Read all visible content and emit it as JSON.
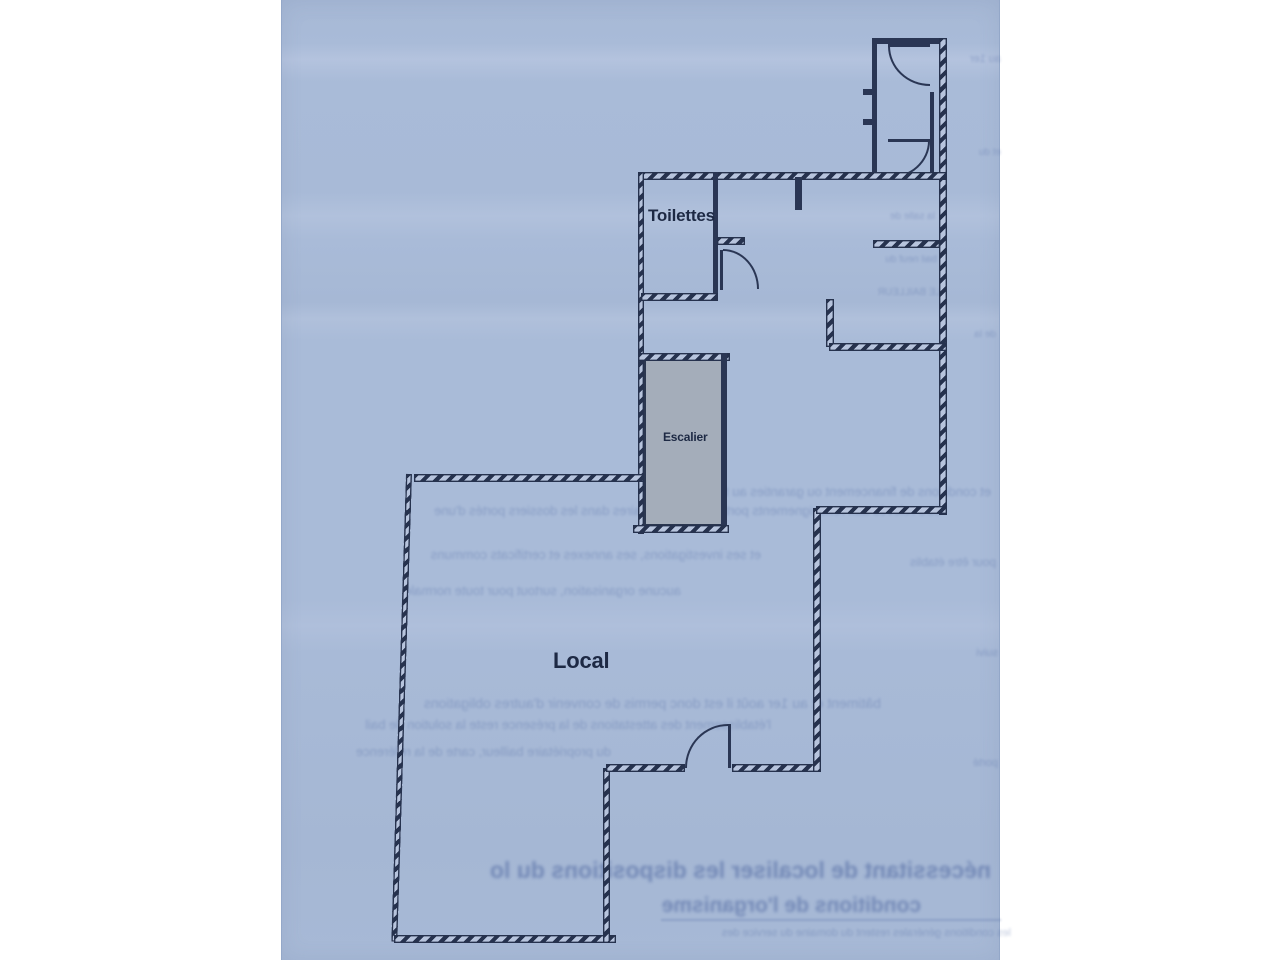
{
  "labels": {
    "toilettes": "Toilettes",
    "escalier": "Escalier",
    "local": "Local"
  },
  "colors": {
    "paper_blue": "#a8bad7",
    "ink_navy": "#26324e",
    "stair_gray": "#a4adba",
    "page_white": "#ffffff"
  },
  "ghost": {
    "g1": "au 1er",
    "g2": "et du",
    "g3": "la salle de",
    "g4": "bail neuf du",
    "g5": "LE BAILLEUR",
    "g6": "et conditions de financement ou garanties au titre des",
    "g7": "être relevés aux renseignements portés et commentaires dans les dossiers portés d'une",
    "g8": "et ses investigations, ses annexes et certificats communs",
    "g9": "pour être établis",
    "g10": "aucune organisation, surtout pour toute normale",
    "g11": "bâtiment et au 1er août il est donc permis de convenir d'autres obligations",
    "g12": "l'établissement des attestations de la présence reste la solution de bail",
    "g13": "du propriétaire bailleur, carte de la référence",
    "g14": "nécessitant de localiser les dispositions du local",
    "g15": "conditions de l'organisme",
    "g16": "les conditions générales restent du domaine du service des",
    "g17": "de la",
    "g18": "suivi",
    "g19": "porté"
  }
}
